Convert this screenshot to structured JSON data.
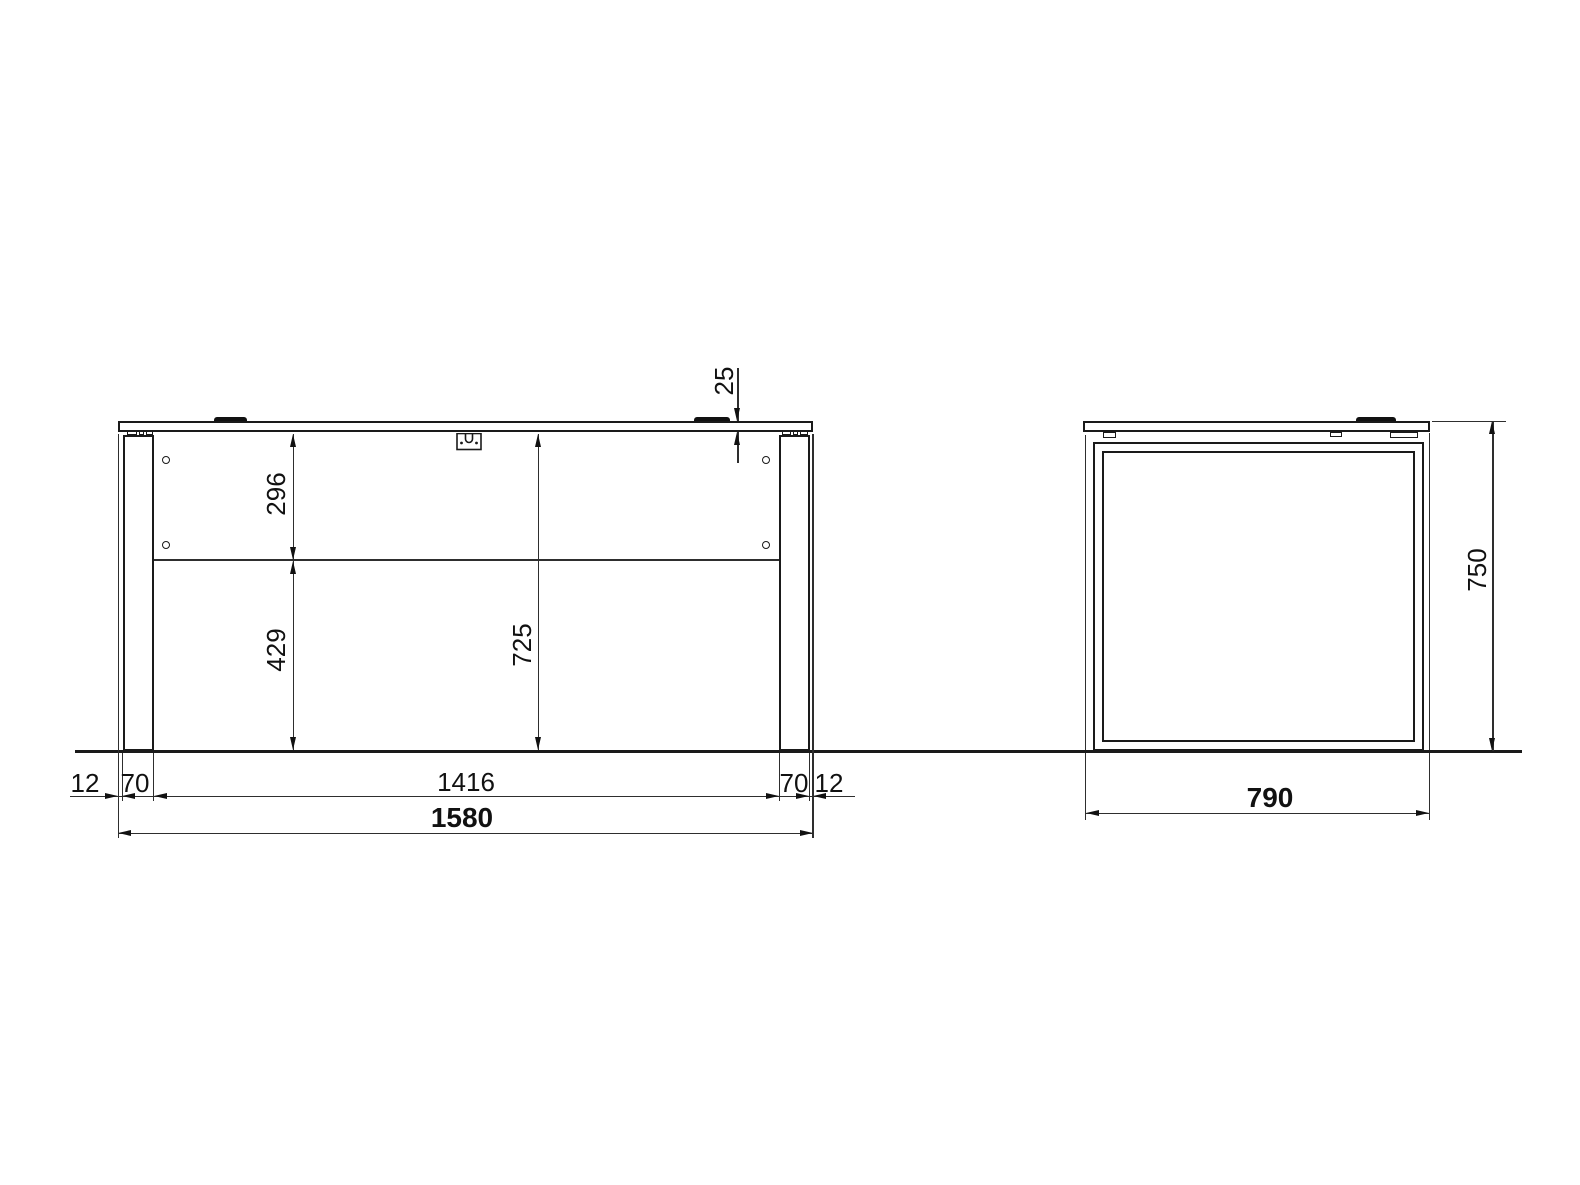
{
  "drawing": {
    "type": "furniture technical drawing, desk front and side elevation",
    "colors": {
      "line": "#1a1a1a",
      "background": "#ffffff"
    },
    "front_view": {
      "top_thickness": "25",
      "panel_height": "296",
      "panel_to_floor": "429",
      "clearance_height": "725",
      "left_overhang": "12",
      "left_leg_width": "70",
      "inner_width": "1416",
      "right_leg_width": "70",
      "right_overhang": "12",
      "total_width": "1580"
    },
    "side_view": {
      "total_height": "750",
      "depth": "790"
    }
  }
}
